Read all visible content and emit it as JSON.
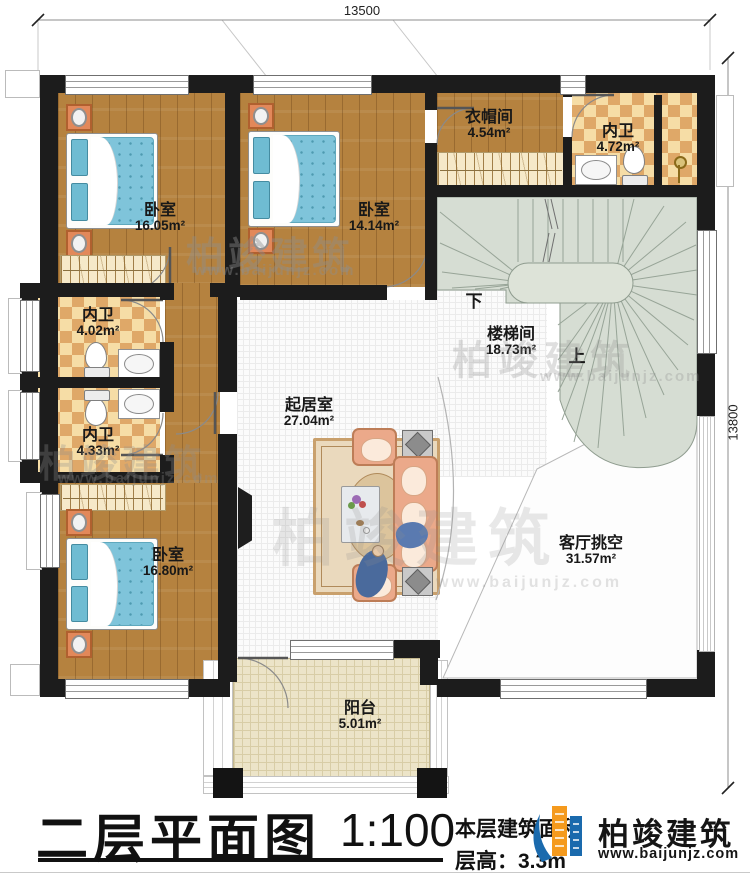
{
  "title": {
    "plan_name": "二层平面图",
    "scale": "1:100",
    "area_note": "本层建筑面积",
    "floor_height": "层高：3.3m"
  },
  "dimensions": {
    "top": "13500",
    "right": "13800"
  },
  "rooms": [
    {
      "id": "bedroom-1",
      "name": "卧室",
      "area": "16.05m²"
    },
    {
      "id": "bedroom-2",
      "name": "卧室",
      "area": "14.14m²"
    },
    {
      "id": "cloakroom",
      "name": "衣帽间",
      "area": "4.54m²"
    },
    {
      "id": "bath-top",
      "name": "内卫",
      "area": "4.72m²"
    },
    {
      "id": "bath-mid-1",
      "name": "内卫",
      "area": "4.02m²"
    },
    {
      "id": "bath-mid-2",
      "name": "内卫",
      "area": "4.33m²"
    },
    {
      "id": "bedroom-3",
      "name": "卧室",
      "area": "16.80m²"
    },
    {
      "id": "living",
      "name": "起居室",
      "area": "27.04m²"
    },
    {
      "id": "stairwell",
      "name": "楼梯间",
      "area": "18.73m²"
    },
    {
      "id": "void",
      "name": "客厅挑空",
      "area": "31.57m²"
    },
    {
      "id": "balcony",
      "name": "阳台",
      "area": "5.01m²"
    }
  ],
  "stairs": {
    "down_label": "下",
    "up_label": "上"
  },
  "watermark": {
    "brand": "柏竣建筑",
    "url": "www.baijunjz.com"
  },
  "logo": {
    "brand": "柏竣建筑",
    "url": "www.baijunjz.com"
  },
  "colors": {
    "wall": "#1c1c1c",
    "wood": "#b5823f",
    "bath_tile": "#dfa868",
    "stair": "#d6ddd3",
    "sofa": "#eba98a",
    "logo_blue": "#1a6aad",
    "logo_orange": "#f59a1d"
  }
}
